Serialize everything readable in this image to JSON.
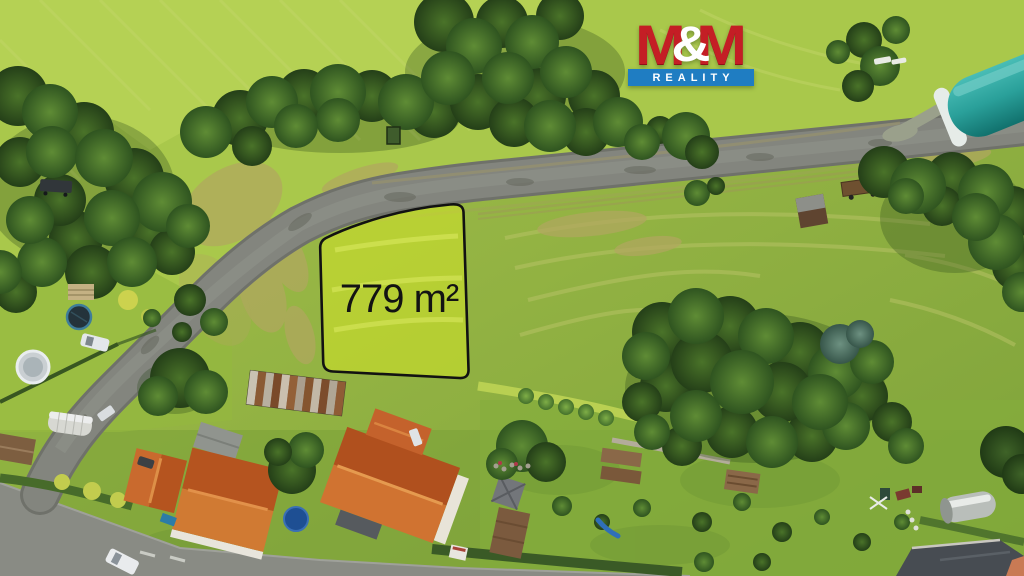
{
  "photo": {
    "description": "Aerial drone photo of a building plot for sale in a village",
    "plot": {
      "area_label": "779 m²",
      "outline_color": "#121212",
      "highlight_color": "#e8f51e"
    },
    "logo": {
      "m_left": "M",
      "ampersand": "&",
      "m_right": "M",
      "wordmark": "REALITY",
      "red": "#c41e25",
      "blue": "#1f7dc2",
      "white": "#ffffff"
    },
    "colors": {
      "grass": "#9cba44",
      "road": "#83857e",
      "roof_orange": "#c4622c",
      "barn_teal": "#2aa09a"
    }
  }
}
